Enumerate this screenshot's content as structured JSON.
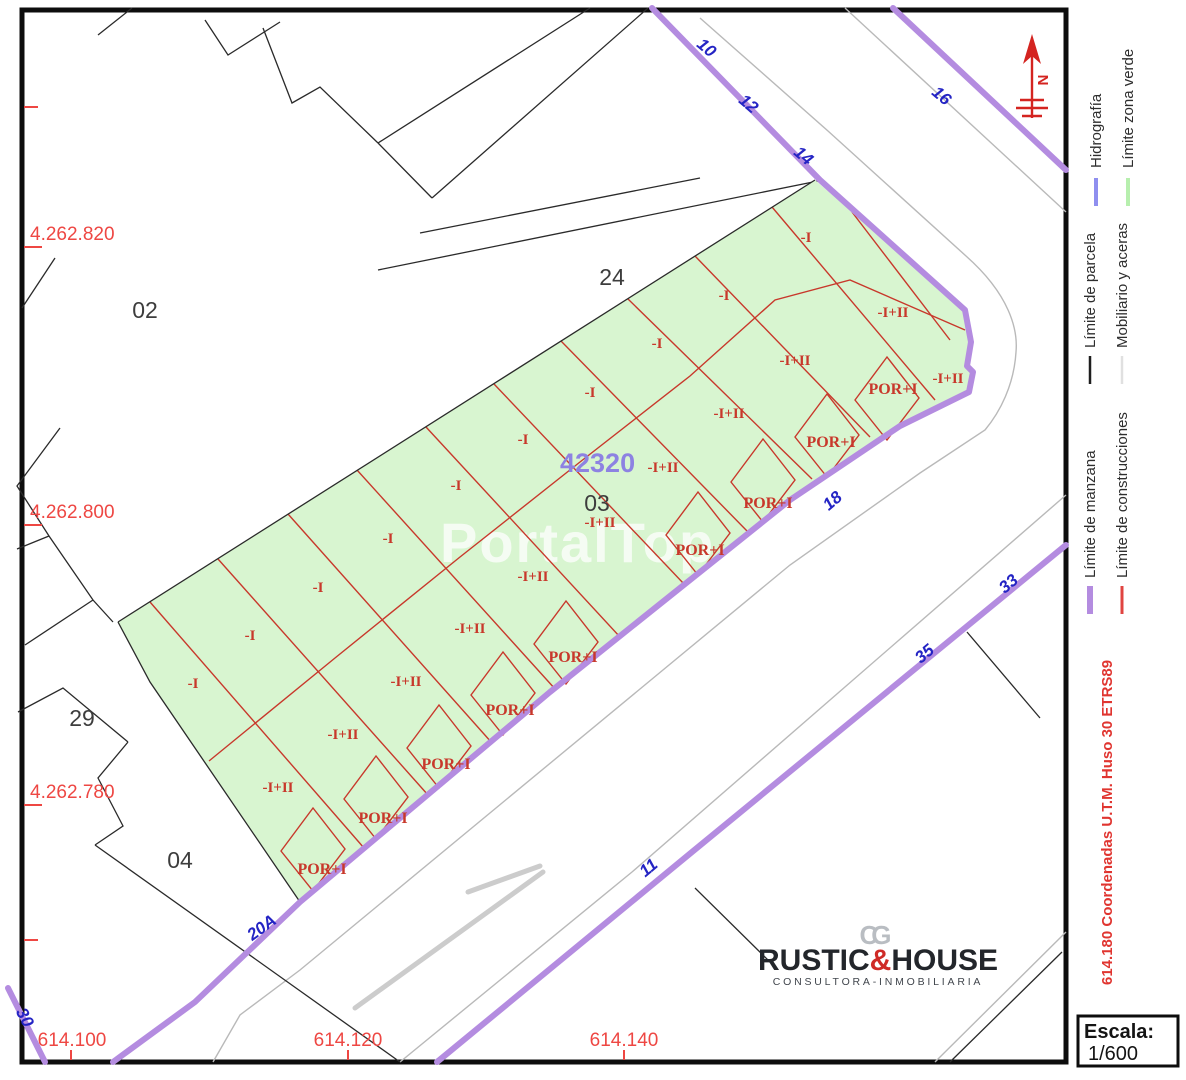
{
  "map": {
    "watermark": "PortalTop",
    "zone_code": {
      "text": "42320"
    },
    "north_label": "N",
    "block_labels": [
      {
        "text": "02",
        "x": 145,
        "y": 318
      },
      {
        "text": "24",
        "x": 612,
        "y": 285
      },
      {
        "text": "03",
        "x": 597,
        "y": 511
      },
      {
        "text": "29",
        "x": 82,
        "y": 726
      },
      {
        "text": "04",
        "x": 180,
        "y": 868
      }
    ],
    "parcel_labels": [
      {
        "text": "-I",
        "x": 193,
        "y": 688
      },
      {
        "text": "-I",
        "x": 250,
        "y": 640
      },
      {
        "text": "-I",
        "x": 318,
        "y": 592
      },
      {
        "text": "-I",
        "x": 388,
        "y": 543
      },
      {
        "text": "-I",
        "x": 456,
        "y": 490
      },
      {
        "text": "-I",
        "x": 523,
        "y": 444
      },
      {
        "text": "-I",
        "x": 590,
        "y": 397
      },
      {
        "text": "-I",
        "x": 657,
        "y": 348
      },
      {
        "text": "-I",
        "x": 724,
        "y": 300
      },
      {
        "text": "-I",
        "x": 806,
        "y": 242
      },
      {
        "text": "-I+II",
        "x": 278,
        "y": 792
      },
      {
        "text": "-I+II",
        "x": 343,
        "y": 739
      },
      {
        "text": "-I+II",
        "x": 406,
        "y": 686
      },
      {
        "text": "-I+II",
        "x": 470,
        "y": 633
      },
      {
        "text": "-I+II",
        "x": 533,
        "y": 581
      },
      {
        "text": "-I+II",
        "x": 600,
        "y": 527
      },
      {
        "text": "-I+II",
        "x": 663,
        "y": 472
      },
      {
        "text": "-I+II",
        "x": 729,
        "y": 418
      },
      {
        "text": "-I+II",
        "x": 795,
        "y": 365
      },
      {
        "text": "-I+II",
        "x": 893,
        "y": 317
      },
      {
        "text": "-I+II",
        "x": 948,
        "y": 383
      }
    ],
    "por_labels": [
      {
        "text": "POR+I",
        "x": 322,
        "y": 874
      },
      {
        "text": "POR+I",
        "x": 383,
        "y": 823
      },
      {
        "text": "POR+I",
        "x": 446,
        "y": 769
      },
      {
        "text": "POR+I",
        "x": 510,
        "y": 715
      },
      {
        "text": "POR+I",
        "x": 573,
        "y": 662
      },
      {
        "text": "POR+I",
        "x": 700,
        "y": 555
      },
      {
        "text": "POR+I",
        "x": 768,
        "y": 508
      },
      {
        "text": "POR+I",
        "x": 831,
        "y": 447
      },
      {
        "text": "POR+I",
        "x": 893,
        "y": 394
      }
    ],
    "street_numbers": [
      {
        "text": "10",
        "x": 703,
        "y": 52,
        "rot": 40
      },
      {
        "text": "12",
        "x": 745,
        "y": 108,
        "rot": 40
      },
      {
        "text": "14",
        "x": 800,
        "y": 160,
        "rot": 40
      },
      {
        "text": "16",
        "x": 938,
        "y": 100,
        "rot": 40
      },
      {
        "text": "18",
        "x": 836,
        "y": 505,
        "rot": -40
      },
      {
        "text": "33",
        "x": 1012,
        "y": 588,
        "rot": -40
      },
      {
        "text": "35",
        "x": 928,
        "y": 658,
        "rot": -40
      },
      {
        "text": "11",
        "x": 652,
        "y": 872,
        "rot": -40
      },
      {
        "text": "20A",
        "x": 265,
        "y": 932,
        "rot": -36
      },
      {
        "text": "30",
        "x": 20,
        "y": 1020,
        "rot": 62
      }
    ],
    "coord_labels_left": [
      {
        "text": "4.262.820",
        "x": 30,
        "y": 240
      },
      {
        "text": "4.262.800",
        "x": 30,
        "y": 518
      },
      {
        "text": "4.262.780",
        "x": 30,
        "y": 798
      }
    ],
    "coord_labels_bottom": [
      {
        "text": "614.100",
        "x": 72,
        "y": 1046
      },
      {
        "text": "614.120",
        "x": 348,
        "y": 1046
      },
      {
        "text": "614.140",
        "x": 624,
        "y": 1046
      }
    ]
  },
  "legend": {
    "items": [
      {
        "label": "Hidrografía",
        "color": "#8f8fef",
        "width": 4
      },
      {
        "label": "Límite zona verde",
        "color": "#b7efae",
        "width": 4
      },
      {
        "label": "Límite de parcela",
        "color": "#1e1e1e",
        "width": 2.5
      },
      {
        "label": "Mobiliario y aceras",
        "color": "#e0e0e0",
        "width": 2.5
      },
      {
        "label": "Límite de manzana",
        "color": "#b48ce0",
        "width": 6
      },
      {
        "label": "Límite de construcciones",
        "color": "#e04440",
        "width": 3
      }
    ],
    "coords_note": "614.180 Coordenadas U.T.M. Huso 30 ETRS89",
    "scale_label": "Escala:",
    "scale_value": "1/600"
  },
  "logo": {
    "monogram": "CG",
    "name_left": "RUSTIC",
    "amp": "&",
    "name_right": "HOUSE",
    "subtitle": "CONSULTORA-INMOBILIARIA"
  },
  "colors": {
    "block_boundary_purple": "#b48ce0",
    "green_zone_fill": "#d8f5d0",
    "construction_red": "#c8382b",
    "street_number_blue": "#2424c4",
    "coordinate_red": "#ee4743",
    "sidewalk_gray": "#b9b9b9",
    "parcel_black": "#2a2a2a"
  }
}
